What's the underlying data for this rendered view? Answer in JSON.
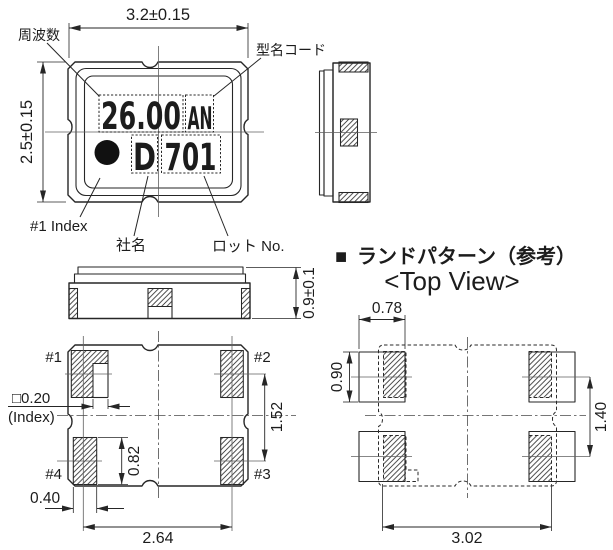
{
  "top_view": {
    "dim_width": "3.2±0.15",
    "dim_height": "2.5±0.15",
    "label_frequency": "周波数",
    "label_model_code": "型名コード",
    "label_index": "#1 Index",
    "label_company": "社名",
    "label_lot": "ロット No.",
    "marking_frequency": "26.00",
    "marking_model_code": "AN",
    "marking_company": "D",
    "marking_lot": "701"
  },
  "side_view": {
    "dim_thickness": "0.9±0.1"
  },
  "bottom_view": {
    "pad1": "#1",
    "pad2": "#2",
    "pad3": "#3",
    "pad4": "#4",
    "dim_index": "□0.20",
    "index_caption": "(Index)",
    "dim_pad_height": "0.82",
    "dim_pitch_v": "1.52",
    "dim_pad_width": "0.40",
    "dim_pitch_h": "2.64"
  },
  "land_pattern": {
    "heading_marker": "■",
    "heading": "ランドパターン（参考）",
    "subtitle": "<Top View>",
    "dim_land_width": "0.78",
    "dim_land_height": "0.90",
    "dim_pitch_v": "1.40",
    "dim_pitch_h": "3.02"
  },
  "colors": {
    "line": "#262626",
    "background": "#ffffff"
  }
}
